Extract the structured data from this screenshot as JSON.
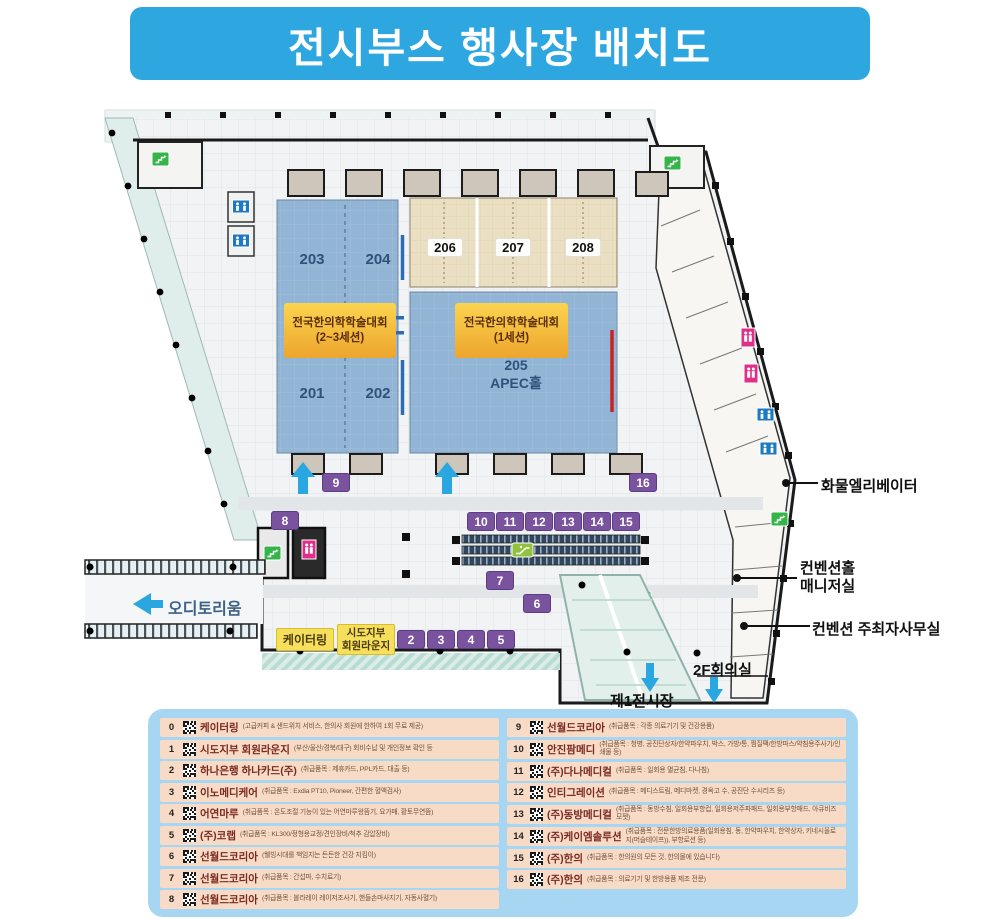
{
  "title": "전시부스 행사장 배치도",
  "plan": {
    "rooms": {
      "r203": "203",
      "r204": "204",
      "r201": "201",
      "r202": "202",
      "r206": "206",
      "r207": "207",
      "r208": "208",
      "r205": "205",
      "apec_hall": "APEC홀"
    },
    "hall_left": {
      "line1": "전국한의학학술대회",
      "line2": "(2~3세션)"
    },
    "hall_right": {
      "line1": "전국한의학학술대회",
      "line2": "(1세션)"
    },
    "area_labels": {
      "auditorium": "오디토리움",
      "exhibition_hall_1": "제1전시장",
      "meeting_room_2f": "2F회의실",
      "catering": "케이터링",
      "lounge_line1": "시도지부",
      "lounge_line2": "회원라운지"
    },
    "callouts": {
      "freight_elevator": "화물엘리베이터",
      "manager_line1": "컨벤션홀",
      "manager_line2": "매니저실",
      "organizer_office": "컨벤션 주최자사무실"
    },
    "booths": [
      "2",
      "3",
      "4",
      "5",
      "6",
      "7",
      "8",
      "9",
      "10",
      "11",
      "12",
      "13",
      "14",
      "15",
      "16"
    ],
    "colors": {
      "banner_blue": "#2ea7e0",
      "booth_purple": "#7a539f",
      "hall_blue": "#92b4d5",
      "room_beige": "#eadfc3",
      "label_orange": "#f2b33b",
      "label_yellow": "#f6df5a",
      "legend_panel_blue": "#a6d6f1",
      "legend_row_peach": "#f8dbc6",
      "legend_name_maroon": "#7b2a22"
    }
  },
  "legend": {
    "left": [
      {
        "no": "0",
        "name": "케이터링",
        "desc": "(고급커피 & 샌드위치 서비스, 한의사 회원에 한하여 1회 무료 제공)"
      },
      {
        "no": "1",
        "name": "시도지부 회원라운지",
        "desc": "(부산/울산/경북/대구) 회비수납 및 개인정보 확인 등"
      },
      {
        "no": "2",
        "name": "하나은행 하나카드(주)",
        "desc": "(취급품목 : 제휴카드, PPL카드, 대출 등)"
      },
      {
        "no": "3",
        "name": "이노메디케어",
        "desc": "(취급품목 : Exdia PT10, Pioneer, 간편한 혈액검사)"
      },
      {
        "no": "4",
        "name": "어연마루",
        "desc": "(취급품목 : 온도조절 기능이 있는 어연마루왕뜸기, 요가매, 황토무연뜸)"
      },
      {
        "no": "5",
        "name": "(주)코랩",
        "desc": "(취급품목 : KL300/정형용교정/견인장비/척추 감압장비)"
      },
      {
        "no": "6",
        "name": "선월드코리아",
        "desc": "(웰빙시대를 책임지는 든든한 건강 지킴이)"
      },
      {
        "no": "7",
        "name": "선월드코리아",
        "desc": "(취급품목 : 간섭파, 수치료기)"
      },
      {
        "no": "8",
        "name": "선월드코리아",
        "desc": "(취급품목 : 볼라레이 레이저조사기, 핸들손마사지기, 자동사혈기)"
      }
    ],
    "right": [
      {
        "no": "9",
        "name": "선월드코리아",
        "desc": "(취급품목 : 각종 의료기기 및 건강용품)"
      },
      {
        "no": "10",
        "name": "안진팜메디",
        "desc": "(취급품목 : 청병, 공진단상자/한약파우치, 박스, 가방/통, 찜질팩/한방파스/약침용주사기/인쇄물 등)"
      },
      {
        "no": "11",
        "name": "(주)다나메디컬",
        "desc": "(취급품목 : 일회용 멸균침, 다나침)"
      },
      {
        "no": "12",
        "name": "인티그레이션",
        "desc": "(취급품목 : 메디스트림, 메디마켓, 경옥고 수, 공진단 수시리즈 등)"
      },
      {
        "no": "13",
        "name": "(주)동방메디컬",
        "desc": "(취급품목 : 동방수침, 일회용부항컵, 일회용저주파패드, 일회용부항패드, 아큐비즈모젯)"
      },
      {
        "no": "14",
        "name": "(주)케이엠솔루션",
        "desc": "(취급품목 : 전문한방의료용품(일회용침, 동, 한약파우치, 한약상자, 키네시올로지(머슬테이프)), 부항로션 등)"
      },
      {
        "no": "15",
        "name": "(주)한의",
        "desc": "(취급품목 : 한의원의 모든 것, 한의몰에 있습니다)"
      },
      {
        "no": "16",
        "name": "(주)한의",
        "desc": "(취급품목 : 의료기기 및 한방용품 제조 전문)"
      }
    ]
  }
}
